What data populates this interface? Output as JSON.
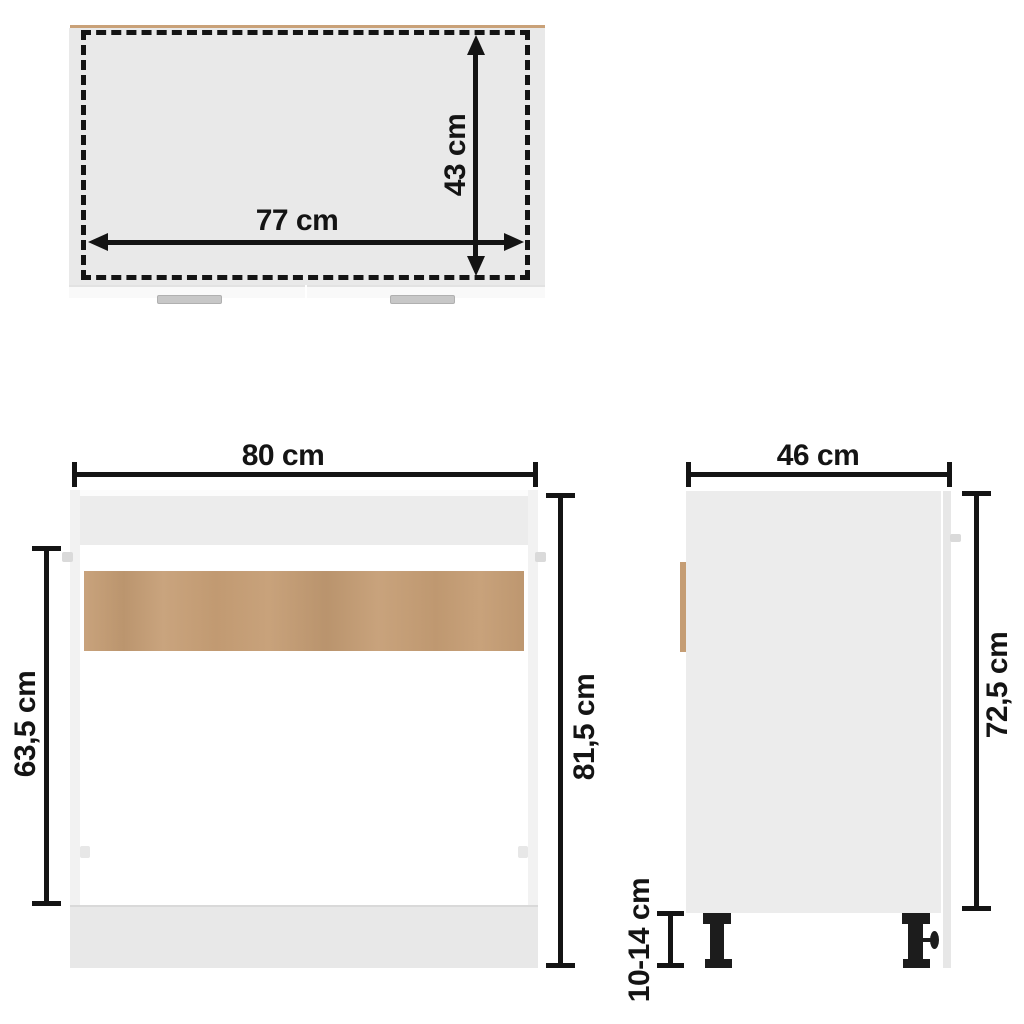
{
  "colors": {
    "background": "#ffffff",
    "line": "#141414",
    "board_gray": "#e9e9e9",
    "panel_gray": "#ececec",
    "panel_light": "#f2f2f2",
    "plinth_gray": "#e8e8e8",
    "door_white": "#f9f9f9",
    "wood_tan": "#c59d74",
    "wood_edge": "#c9a178",
    "handle_gray": "#c7c7c7",
    "hinge_gray": "#dadada",
    "leg_black": "#1c1c1c"
  },
  "views": {
    "top": {
      "name": "top view (interior)",
      "inner_width": {
        "label": "77 cm"
      },
      "inner_depth": {
        "label": "43 cm"
      }
    },
    "front": {
      "name": "front view",
      "width": {
        "label": "80 cm"
      },
      "total_height": {
        "label": "81,5 cm"
      },
      "opening_height": {
        "label": "63,5 cm"
      }
    },
    "side": {
      "name": "side view",
      "depth": {
        "label": "46 cm"
      },
      "body_height": {
        "label": "72,5 cm"
      },
      "leg_height": {
        "label": "10-14 cm"
      }
    }
  }
}
